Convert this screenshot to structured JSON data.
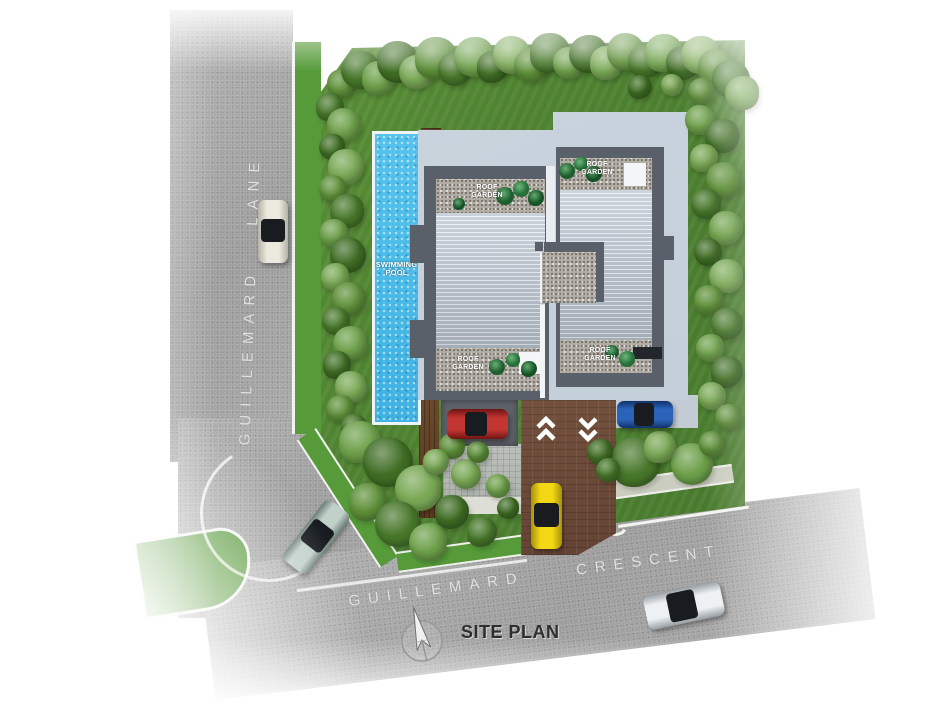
{
  "title": "SITE PLAN",
  "roads": {
    "lane": {
      "name": "GUILLEMARD LANE"
    },
    "crescent": {
      "name": "GUILLEMARD CRESCENT"
    }
  },
  "site": {
    "swimming_pool": {
      "label": "SWIMMING POOL"
    },
    "pool_deck": {
      "label": "POOL DECK"
    },
    "roof_gardens": [
      {
        "position": "north-west",
        "label": "ROOF GARDEN"
      },
      {
        "position": "north-east",
        "label": "ROOF GARDEN"
      },
      {
        "position": "south-west",
        "label": "ROOF GARDEN"
      },
      {
        "position": "south-east",
        "label": "ROOF GARDEN"
      }
    ],
    "driveway": {
      "entry_marking": "double-chevron-up",
      "exit_marking": "double-chevron-down"
    }
  },
  "vehicles": [
    {
      "color": "white",
      "hex": "#e9e7dc",
      "location": "parked on Guillemard Lane"
    },
    {
      "color": "red",
      "hex": "#b72c27",
      "location": "parking bay beside driveway"
    },
    {
      "color": "blue",
      "hex": "#1d4e96",
      "location": "east side of building"
    },
    {
      "color": "yellow",
      "hex": "#efd116",
      "location": "on driveway"
    },
    {
      "color": "teal",
      "hex": "#aec1bb",
      "location": "road junction"
    },
    {
      "color": "silver",
      "hex": "#dfe3e6",
      "location": "on Guillemard Crescent"
    }
  ],
  "compass": {
    "icon": "north-arrow"
  },
  "colors": {
    "pool_water": "#4fc0ea",
    "lawn": "#4e8230",
    "road": "#a9a9a9",
    "roof_stripes": "#b6c1cd",
    "roof_garden_gravel": "#b3aea5",
    "timber_deck": "#5e4226",
    "driveway_brick": "#6d4c3a",
    "building_wall": "#59606a",
    "platform": "#c6d0da"
  }
}
